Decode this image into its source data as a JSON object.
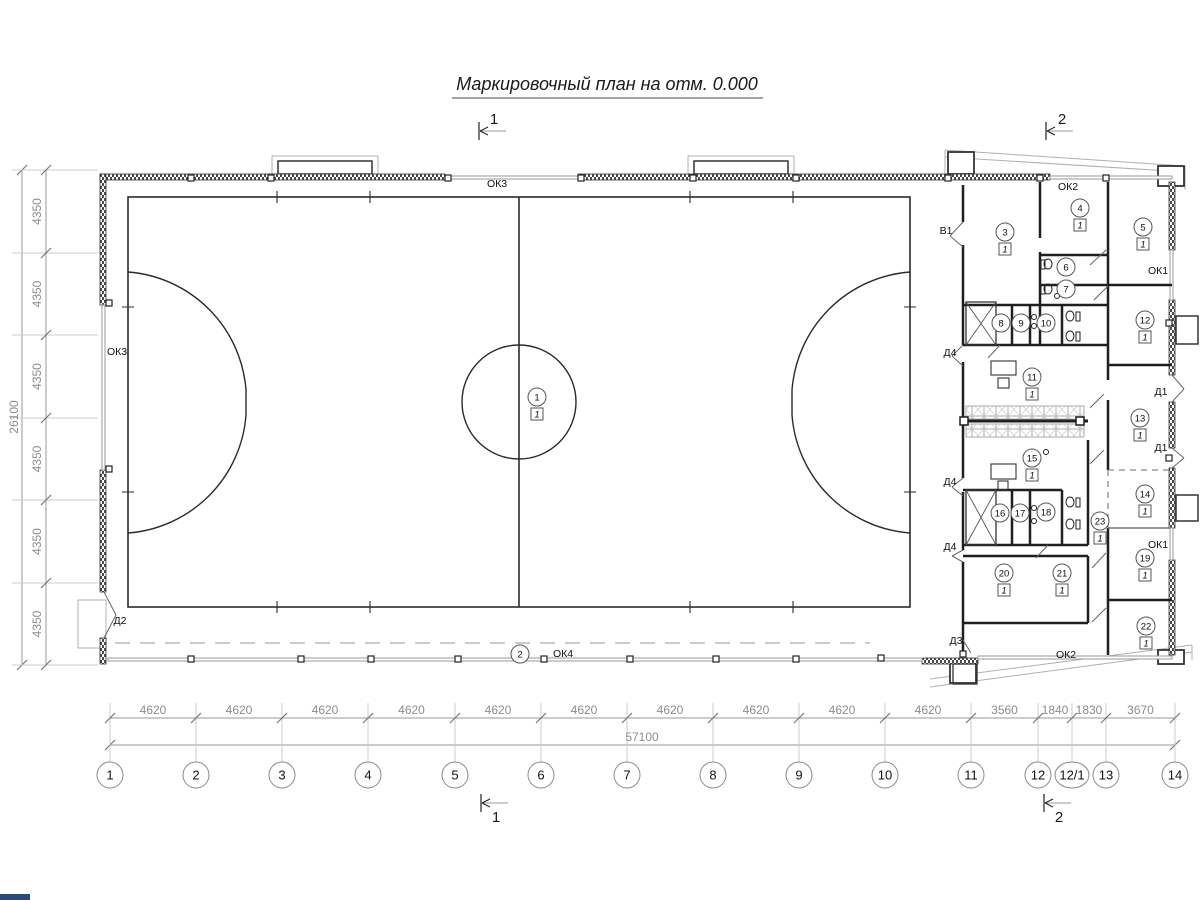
{
  "title": "Маркировочный план на отм. 0.000",
  "sections": {
    "one": "1",
    "two": "2"
  },
  "floor_mark": "1",
  "axes": {
    "labels": [
      "1",
      "2",
      "3",
      "4",
      "5",
      "6",
      "7",
      "8",
      "9",
      "10",
      "11",
      "12",
      "12/1",
      "13",
      "14"
    ],
    "x": [
      110,
      196,
      282,
      368,
      455,
      541,
      627,
      713,
      799,
      885,
      971,
      1038,
      1072,
      1106,
      1175
    ],
    "y": 775
  },
  "dim_bottom": {
    "values": [
      "4620",
      "4620",
      "4620",
      "4620",
      "4620",
      "4620",
      "4620",
      "4620",
      "4620",
      "4620",
      "3560",
      "1840",
      "1830",
      "3670"
    ],
    "total": "57100"
  },
  "dim_left": {
    "values": [
      "4350",
      "4350",
      "4350",
      "4350",
      "4350",
      "4350"
    ],
    "y_bounds": [
      170,
      253,
      335,
      418,
      500,
      583,
      665
    ],
    "total": "26100"
  },
  "rooms": [
    {
      "n": "1",
      "x": 537,
      "y": 397,
      "f": 1
    },
    {
      "n": "2",
      "x": 520,
      "y": 654,
      "f": 0
    },
    {
      "n": "3",
      "x": 1005,
      "y": 232,
      "f": 1
    },
    {
      "n": "4",
      "x": 1080,
      "y": 208,
      "f": 1
    },
    {
      "n": "5",
      "x": 1143,
      "y": 227,
      "f": 1
    },
    {
      "n": "6",
      "x": 1066,
      "y": 267,
      "f": 0
    },
    {
      "n": "7",
      "x": 1066,
      "y": 289,
      "f": 0
    },
    {
      "n": "8",
      "x": 1001,
      "y": 323,
      "f": 0
    },
    {
      "n": "9",
      "x": 1021,
      "y": 323,
      "f": 0
    },
    {
      "n": "10",
      "x": 1046,
      "y": 323,
      "f": 0
    },
    {
      "n": "11",
      "x": 1032,
      "y": 377,
      "f": 1
    },
    {
      "n": "12",
      "x": 1145,
      "y": 320,
      "f": 1
    },
    {
      "n": "13",
      "x": 1140,
      "y": 418,
      "f": 1
    },
    {
      "n": "14",
      "x": 1145,
      "y": 494,
      "f": 1
    },
    {
      "n": "15",
      "x": 1032,
      "y": 458,
      "f": 1
    },
    {
      "n": "16",
      "x": 1000,
      "y": 513,
      "f": 0
    },
    {
      "n": "17",
      "x": 1020,
      "y": 513,
      "f": 0
    },
    {
      "n": "18",
      "x": 1046,
      "y": 512,
      "f": 0
    },
    {
      "n": "19",
      "x": 1145,
      "y": 558,
      "f": 1
    },
    {
      "n": "20",
      "x": 1004,
      "y": 573,
      "f": 1
    },
    {
      "n": "21",
      "x": 1062,
      "y": 573,
      "f": 1
    },
    {
      "n": "22",
      "x": 1146,
      "y": 626,
      "f": 1
    },
    {
      "n": "23",
      "x": 1100,
      "y": 521,
      "f": 1
    }
  ],
  "wall_labels": [
    {
      "t": "ОК3",
      "x": 497,
      "y": 187
    },
    {
      "t": "ОК3",
      "x": 117,
      "y": 355
    },
    {
      "t": "ОК4",
      "x": 563,
      "y": 657
    },
    {
      "t": "ОК2",
      "x": 1068,
      "y": 190
    },
    {
      "t": "ОК2",
      "x": 1066,
      "y": 658
    },
    {
      "t": "ОК1",
      "x": 1158,
      "y": 274
    },
    {
      "t": "ОК1",
      "x": 1158,
      "y": 548
    },
    {
      "t": "Д1",
      "x": 1161,
      "y": 395
    },
    {
      "t": "Д1",
      "x": 1161,
      "y": 451
    },
    {
      "t": "Д2",
      "x": 120,
      "y": 624
    },
    {
      "t": "Д3",
      "x": 956,
      "y": 644
    },
    {
      "t": "Д4",
      "x": 950,
      "y": 356
    },
    {
      "t": "Д4",
      "x": 950,
      "y": 485
    },
    {
      "t": "Д4",
      "x": 950,
      "y": 550
    },
    {
      "t": "В1",
      "x": 946,
      "y": 234
    }
  ],
  "colors": {
    "wall": "#1f1f1f",
    "field": "#2b2b2b",
    "dim_line": "#9a9a9a",
    "dim_text": "#8c8c8c",
    "light": "#b0b0b0",
    "label": "#111111"
  }
}
